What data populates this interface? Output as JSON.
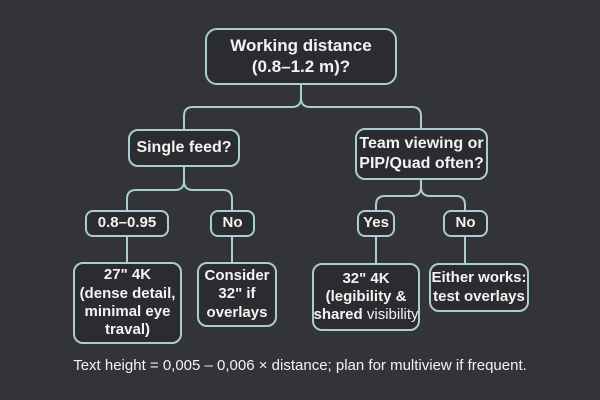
{
  "colors": {
    "background": "#323438",
    "box_fill": "#2a2c2f",
    "line": "#a9cdd2",
    "text": "#f3f3f3"
  },
  "nodes": {
    "root": {
      "text": "Working distance\n(0.8–1.2 m)?"
    },
    "single_feed": {
      "text": "Single feed?"
    },
    "team_viewing": {
      "text": "Team viewing or\nPIP/Quad often?"
    },
    "range_08_095": {
      "text": "0.8–0.95"
    },
    "single_no": {
      "text": "No"
    },
    "team_yes": {
      "text": "Yes"
    },
    "team_no": {
      "text": "No"
    },
    "leaf_27_4k": {
      "text": "27\" 4K\n(dense detail,\nminimal eye\ntraval)"
    },
    "leaf_consider_32": {
      "text": "Consider\n32\" if\noverlays"
    },
    "leaf_32_4k": {
      "text": "32\" 4K\n(legibility &\nshared",
      "text_light": " visibility"
    },
    "leaf_either_works": {
      "text": "Either works:\ntest overlays"
    }
  },
  "caption": {
    "text": "Text height = 0,005 – 0,006 × distance; plan for multiview if frequent."
  }
}
